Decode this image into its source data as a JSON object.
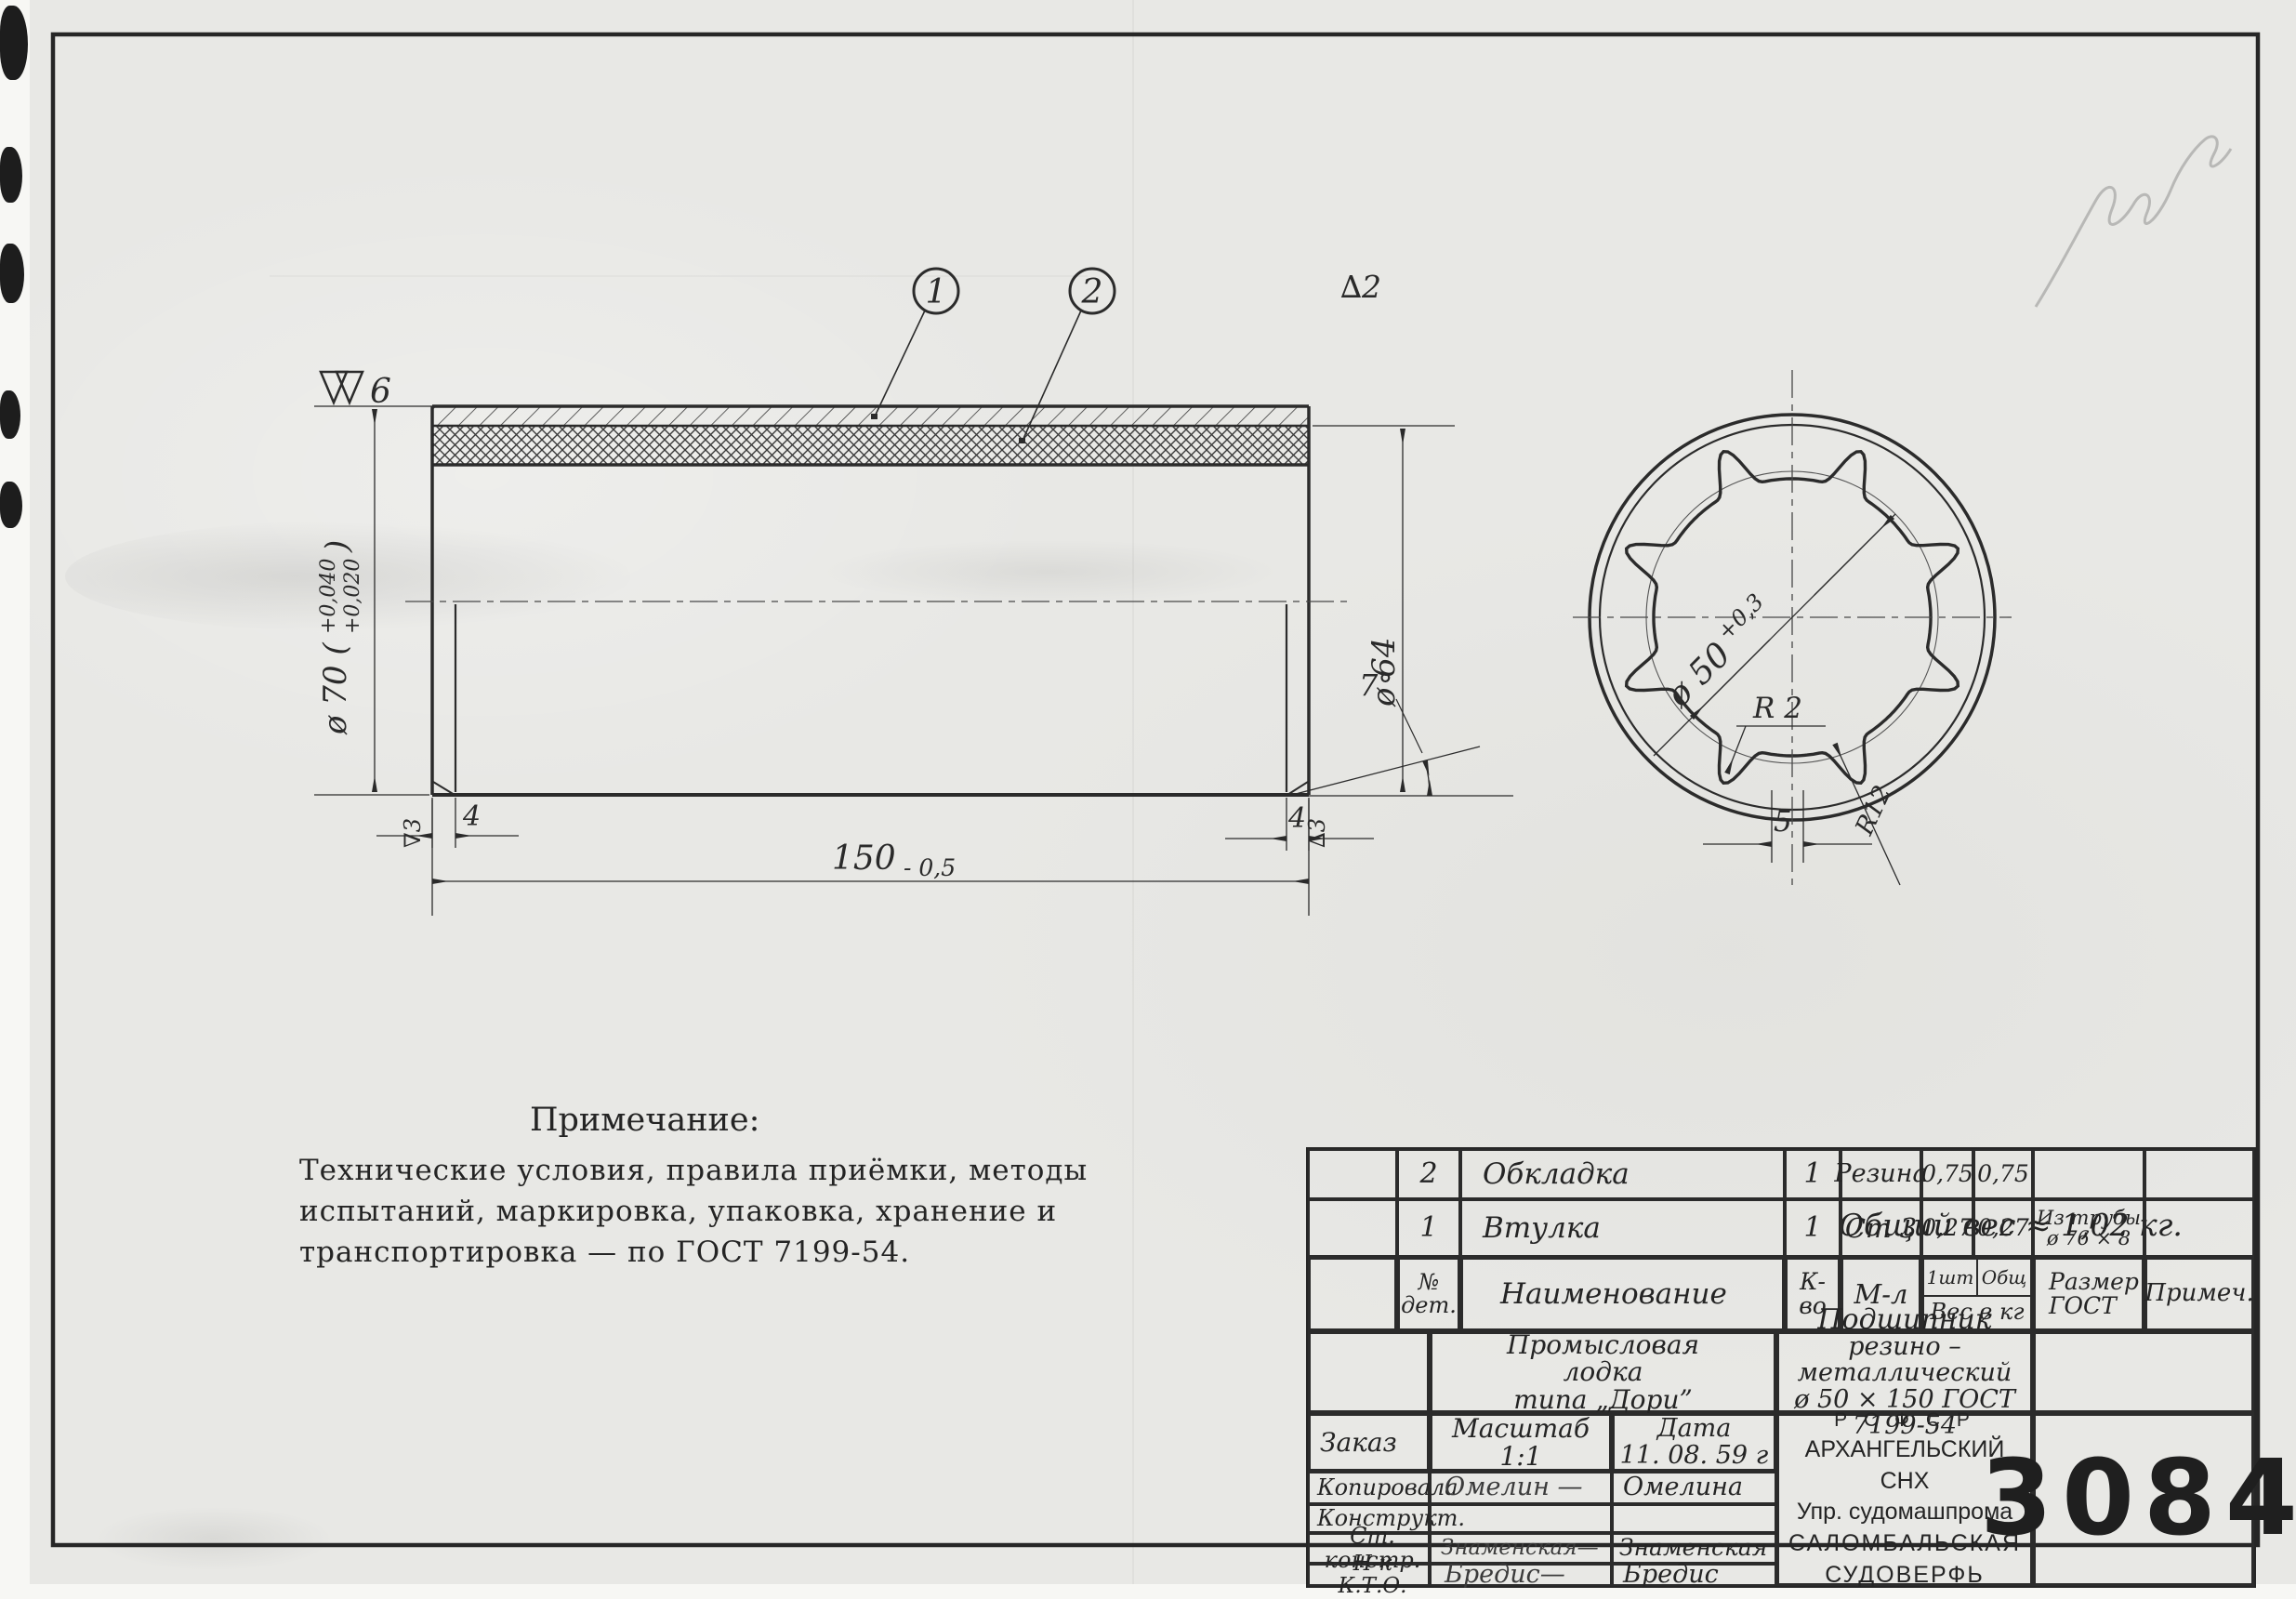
{
  "sheet": {
    "drawing_number": "3084",
    "weight_note": "Общий вес ≈ 1,02 кг."
  },
  "notes": {
    "title": "Примечание:",
    "line1": "Технические  условия, правила приёмки, методы",
    "line2": "испытаний, маркировка, упаковка, хранение  и",
    "line3": "транспортировка   —   по   ГОСТ 7199-54."
  },
  "callouts": {
    "c1": "1",
    "c2": "2"
  },
  "dims": {
    "surface_top": "6",
    "dia70": "ø 70 (",
    "dia70_up": "+0,040",
    "dia70_low": "+0,020",
    "dia70_close": ")",
    "delta2": "∆2",
    "dia64": "ø 64",
    "len150": "150",
    "len150_tol": "- 0,5",
    "left4": "4",
    "left_finish": "∇3",
    "right4": "4",
    "right_finish": "∆3",
    "angle": "7°",
    "dia50": "ø 50",
    "dia50_tol": "+0,3",
    "r2": "R 2",
    "r12": "R12",
    "groove5": "5"
  },
  "parts_table": {
    "header": {
      "no_line1": "№",
      "no_line2": "дет.",
      "name": "Наименование",
      "qty": "К-во",
      "material": "М-л",
      "w_each": "1шт",
      "w_total": "Общ",
      "w_label": "Вес в кг",
      "size_line1": "Размер",
      "size_line2": "ГОСТ",
      "note": "Примеч."
    },
    "rows": [
      {
        "no": "2",
        "name": "Обкладка",
        "qty": "1",
        "material": "Резина",
        "w_each": "0,75",
        "w_total": "0,75",
        "size_line1": "",
        "size_line2": ""
      },
      {
        "no": "1",
        "name": "Втулка",
        "qty": "1",
        "material": "Ст 3",
        "w_each": "0,27",
        "w_total": "0,27",
        "size_line1": "Из трубы",
        "size_line2": "ø 76 × 8"
      }
    ]
  },
  "title_block": {
    "product_line1": "Промысловая",
    "product_line2": "лодка",
    "product_line3": "типа  „Дори”",
    "title_line1": "Подшипник",
    "title_line2": "резино – металлический",
    "title_line3": "ø 50 × 150      ГОСТ 7199-54",
    "order_label": "Заказ",
    "scale_label": "Масштаб",
    "scale_value": "1:1",
    "date_label": "Дата",
    "date_value": "11. 08. 59 г",
    "sig_rows": [
      {
        "label": "Копировала",
        "signature": "Омелин —",
        "name": "Омелина"
      },
      {
        "label": "Конструкт.",
        "signature": "",
        "name": ""
      },
      {
        "label": "Ст. констр.",
        "signature": "Знаменская—",
        "name": "Знаменская"
      },
      {
        "label": "Н-к  К.Т.О.",
        "signature": "Бредис—",
        "name": "Бредис"
      }
    ],
    "org_line1": "Р С Ф С Р",
    "org_line2": "АРХАНГЕЛЬСКИЙ СНХ",
    "org_line3": "Упр. судомашпрома",
    "org_line4": "САЛОМБАЛЬСКАЯ",
    "org_line5": "СУДОВЕРФЬ"
  }
}
